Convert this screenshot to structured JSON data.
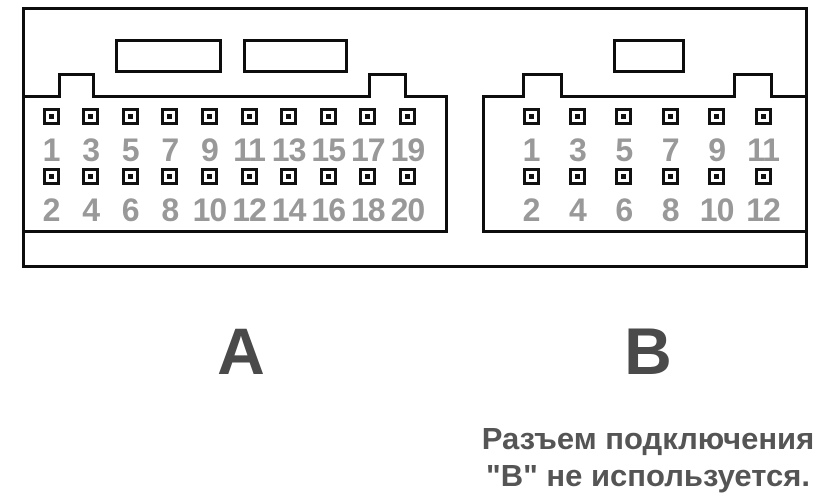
{
  "diagram_title": "Connector pinout diagram",
  "colors": {
    "line": "#0d0d0d",
    "pin_number": "#999999",
    "letter": "#4a4a4a",
    "note_text": "#555555",
    "background": "#ffffff"
  },
  "connectors": [
    {
      "id": "A",
      "label": "A",
      "top_pins": [
        1,
        3,
        5,
        7,
        9,
        11,
        13,
        15,
        17,
        19
      ],
      "bottom_pins": [
        2,
        4,
        6,
        8,
        10,
        12,
        14,
        16,
        18,
        20
      ]
    },
    {
      "id": "B",
      "label": "B",
      "top_pins": [
        1,
        3,
        5,
        7,
        9,
        11
      ],
      "bottom_pins": [
        2,
        4,
        6,
        8,
        10,
        12
      ]
    }
  ],
  "note": {
    "line1": "Разъем подключения",
    "line2": "\"В\" не используется."
  }
}
